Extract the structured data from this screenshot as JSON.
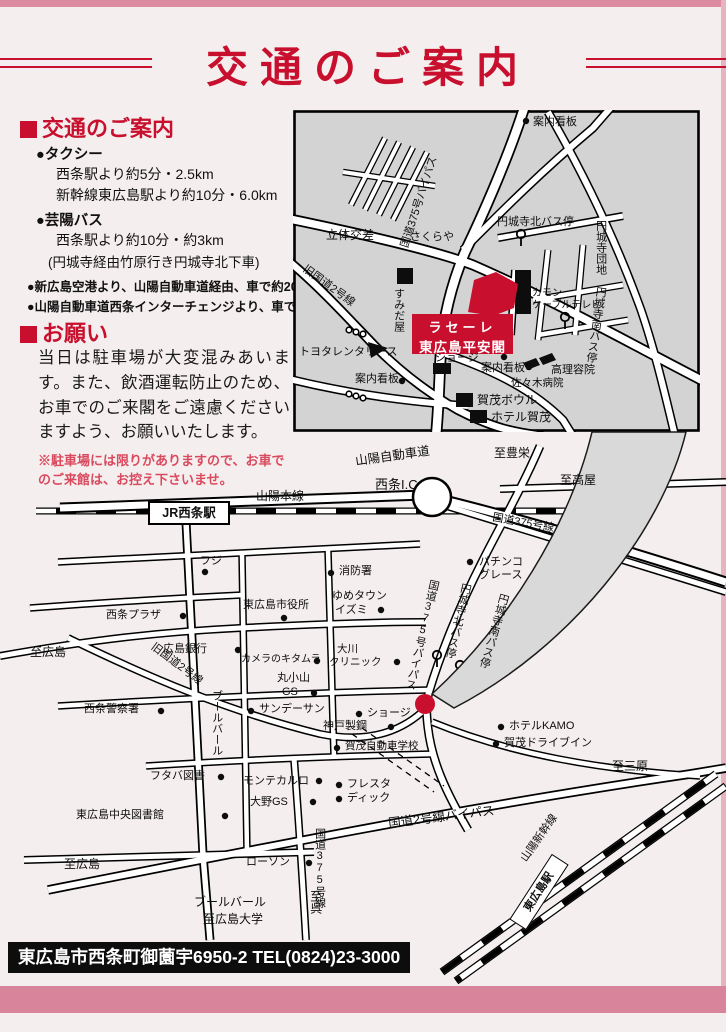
{
  "page": {
    "title": "交通のご案内",
    "footer": "東広島市西条町御薗宇6950-2 TEL(0824)23-3000",
    "accent_red": "#c8102e",
    "pink": "#dc8ba1",
    "map_gray": "#d3d3d3"
  },
  "guide": {
    "heading": "交通のご案内",
    "items": [
      {
        "title": "●タクシー",
        "lines": [
          "西条駅より約5分・2.5km",
          "新幹線東広島駅より約10分・6.0km"
        ]
      },
      {
        "title": "●芸陽バス",
        "lines": [
          "西条駅より約10分・約3km",
          "(円城寺経由竹原行き円城寺北下車)"
        ]
      },
      {
        "title": "●新広島空港より、山陽自動車道経由、車で約20分",
        "lines": []
      },
      {
        "title": "●山陽自動車道西条インターチェンジより、車で約5分",
        "lines": []
      }
    ]
  },
  "request": {
    "heading": "お願い",
    "body": "当日は駐車場が大変混みあいます。また、飲酒運転防止のため、お車でのご来閣をご遠慮くださいますよう、お願いいたします。",
    "note": "※駐車場には限りがありますので、お車でのご来館は、お控え下さいませ。"
  },
  "detail_map": {
    "venue": {
      "line1": "ラセーレ",
      "line2": "東広島平安閣"
    },
    "labels": {
      "r375_bypass": "国道375号バイパス",
      "rittai": "立体交差",
      "sakuraya": "さくらや",
      "kanban_top": "案内看板",
      "enjoji_kita_bus": "円城寺北バス停",
      "enjoji_danchi": "円城寺団地",
      "enjoji_minami_bus": "円城寺南バス停",
      "sumidaya": "すみだ屋",
      "kyu_r2": "旧国道2号線",
      "toyota_rental": "トヨタレンタリース",
      "kanban_left": "案内看板",
      "kamon1": "カモン",
      "kamon2": "ケーブルテレビ",
      "shoji": "ショージ",
      "kanban_center": "案内看板",
      "barber": "高理容院",
      "sasaki": "佐々木病院",
      "kamo_bowl": "賀茂ボウル",
      "hotel_kamo": "ホテル賀茂"
    }
  },
  "area_map": {
    "labels": {
      "sanyo_expwy": "山陽自動車道",
      "saijo_ic": "西条I.C",
      "to_toyosaka": "至豊栄",
      "to_takaya": "至高屋",
      "r375": "国道375号線",
      "sanyo_line": "山陽本線",
      "jr_saijo": "JR西条駅",
      "fuji": "フジ",
      "fire_station": "消防署",
      "saijo_plaza": "西条プラザ",
      "to_hiroshima_w": "至広島",
      "hiroshima_bank": "広島銀行",
      "city_hall": "東広島市役所",
      "yume1": "ゆめタウン",
      "yume2": "イズミ",
      "kitamura": "カメラのキタムラ",
      "okawa1": "大川",
      "okawa2": "クリニック",
      "maru1": "丸小山",
      "maru2": "GS",
      "kyu_r2": "旧国道2号線",
      "pachinko1": "パチンコ",
      "pachinko2": "グレース",
      "r375_bypass": "国道375号バイパス",
      "enjoji_kita_bus": "円城寺北バス停",
      "enjoji_minami_bus": "円城寺南バス停",
      "police": "西条警察署",
      "sunday_sun": "サンデーサン",
      "kobe_steel": "神戸製鋼",
      "kamo_driving": "賀茂自動車学校",
      "boulevard": "ブールバール",
      "futaba": "フタバ図書",
      "monte_carlo": "モンテカルロ",
      "fresta": "フレスタ",
      "dick": "ディック",
      "ohno_gs": "大野GS",
      "library": "東広島中央図書館",
      "shoji": "ショージ",
      "hotel_kamo": "ホテルKAMO",
      "kamo_drivein": "賀茂ドライブイン",
      "to_mihara": "至三原",
      "r2_bypass": "国道2号線バイパス",
      "lawson": "ローソン",
      "r375_s": "国道375号線",
      "to_kure": "至呉",
      "boulevard_b": "ブールバール",
      "to_hirodai": "至広島大学",
      "to_hiroshima_s": "至広島",
      "shinkansen": "山陽新幹線",
      "higashihiroshima_sta": "東広島駅"
    }
  }
}
